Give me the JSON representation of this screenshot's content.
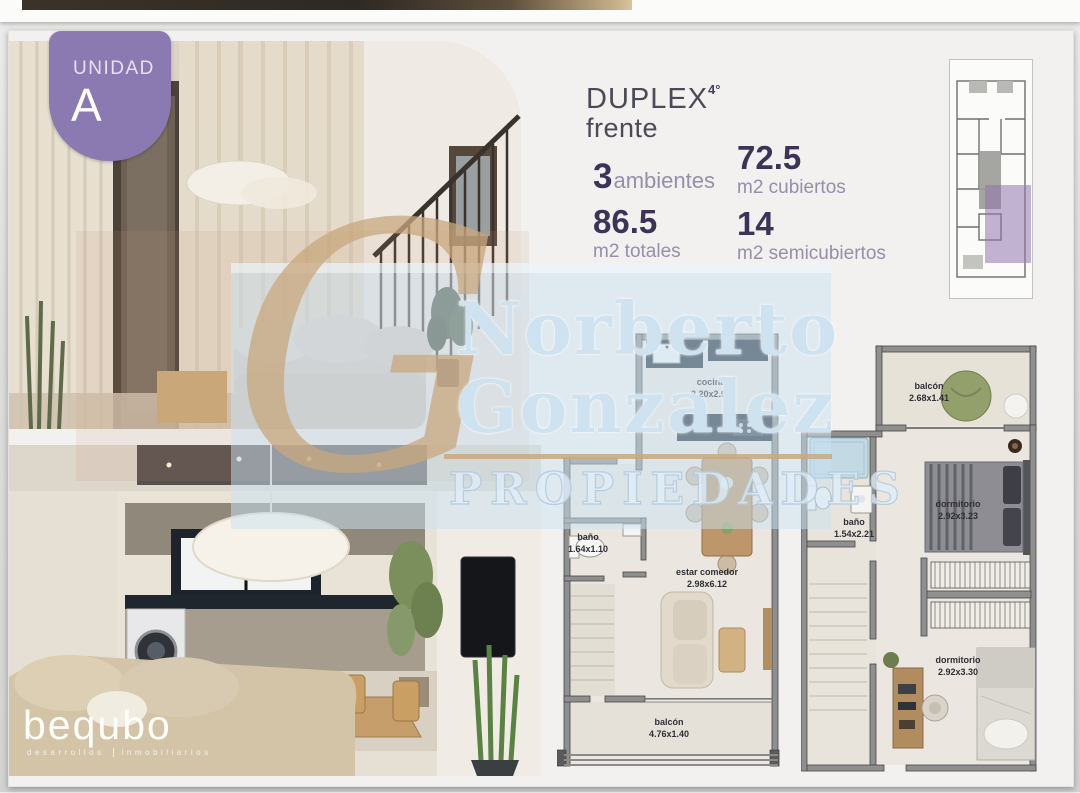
{
  "badge": {
    "unit_label": "UNIDAD",
    "unit_letter": "A"
  },
  "header": {
    "title": "DUPLEX",
    "superscript": "4°",
    "subtitle": "frente"
  },
  "stats": {
    "ambientes": {
      "value": "3",
      "label": "ambientes"
    },
    "cubiertos": {
      "value": "72.5",
      "label": "m2 cubiertos"
    },
    "totales": {
      "value": "86.5",
      "label": "m2 totales"
    },
    "semicubiertos": {
      "value": "14",
      "label": "m2 semicubiertos"
    }
  },
  "plans": {
    "lower": {
      "rooms": {
        "cocina": {
          "name": "cocina",
          "dims": "2.20x2.98"
        },
        "bano": {
          "name": "baño",
          "dims": "1.64x1.10"
        },
        "estar": {
          "name": "estar comedor",
          "dims": "2.98x6.12"
        },
        "balcon": {
          "name": "balcón",
          "dims": "4.76x1.40"
        }
      }
    },
    "upper": {
      "rooms": {
        "balcon": {
          "name": "balcón",
          "dims": "2.68x1.41"
        },
        "bano": {
          "name": "baño",
          "dims": "1.54x2.21"
        },
        "dormitorio1": {
          "name": "dormitorio",
          "dims": "2.92x3.23"
        },
        "dormitorio2": {
          "name": "dormitorio",
          "dims": "2.92x3.30"
        }
      }
    }
  },
  "watermark": {
    "monogram": "G",
    "line1": "Norberto",
    "line2": "Gonzalez",
    "line3": "PROPIEDADES"
  },
  "logo": {
    "brand": "bequbo",
    "tagline_left": "desarrollos",
    "tagline_right": "inmobiliarios"
  },
  "colors": {
    "badge_purple": "#8b79b1",
    "keyplan_highlight": "#8f76ad",
    "stat_number": "#3c3356",
    "stat_label": "#968fa9",
    "title_text": "#4b4a56",
    "watermark_blue": "#cfe2f0",
    "watermark_gold": "#c9a87e",
    "plan_wall": "#8f8f8f",
    "plan_floor": "#ebe7e0",
    "kitchen_counter": "#232d3a"
  }
}
